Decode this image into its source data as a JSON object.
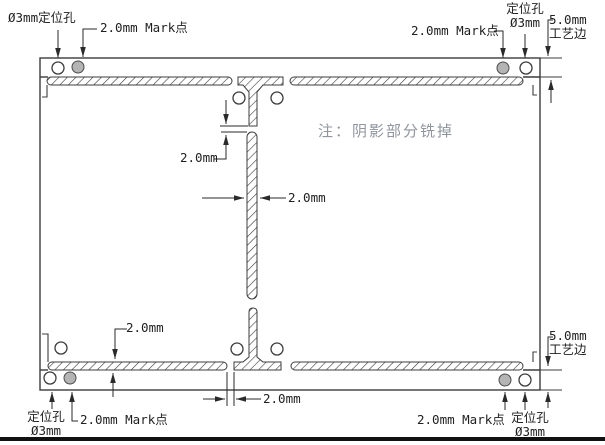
{
  "drawing": {
    "note": "注：阴影部分铣掉",
    "annotations": {
      "top_left": {
        "positioning_hole": "Ø3mm定位孔",
        "mark_point": "2.0mm Mark点"
      },
      "top_right": {
        "mark_point": "2.0mm Mark点",
        "positioning_hole_line1": "定位孔",
        "positioning_hole_line2": "Ø3mm",
        "process_edge_line1": "5.0mm",
        "process_edge_line2": "工艺边"
      },
      "bottom_left": {
        "positioning_hole_line1": "定位孔",
        "positioning_hole_line2": "Ø3mm",
        "mark_point": "2.0mm Mark点"
      },
      "bottom_right": {
        "mark_point": "2.0mm Mark点",
        "positioning_hole_line1": "定位孔",
        "positioning_hole_line2": "Ø3mm",
        "process_edge_line1": "5.0mm",
        "process_edge_line2": "工艺边"
      }
    },
    "dimensions": {
      "top_tab_gap": "2.0mm",
      "center_slot_width": "2.0mm",
      "bottom_slot_thickness": "2.0mm",
      "bottom_tab_gap": "2.0mm"
    },
    "colors": {
      "outline": "#3c3c3c",
      "dimension_line": "#2a2a2a",
      "mark_point_fill": "#b4b4b4",
      "note_text": "#8e959d",
      "label_text": "#1f1f1f",
      "border_bar": "#111111"
    }
  }
}
